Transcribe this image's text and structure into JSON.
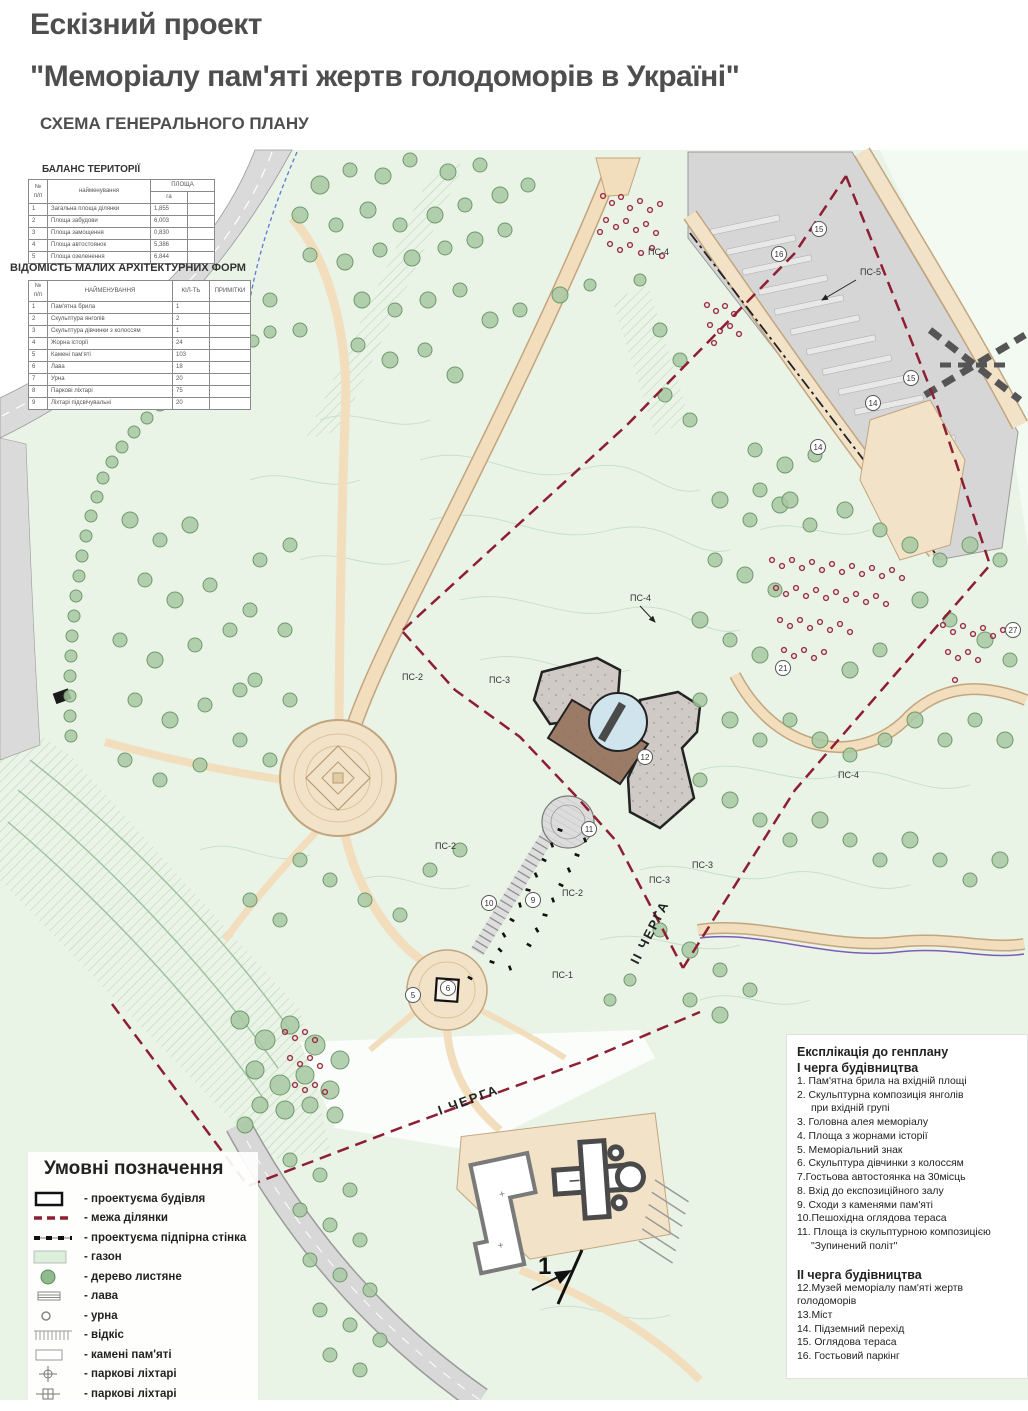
{
  "header": {
    "line1": "Ескізний проект",
    "line2": "\"Меморіалу пам'яті жертв голодоморів в Україні\"",
    "line3": "СХЕМА ГЕНЕРАЛЬНОГО ПЛАНУ"
  },
  "balance_table": {
    "title": "БАЛАНС ТЕРИТОРІЇ",
    "col_num": "№ п/п",
    "col_name": "найменування",
    "col_area": "ПЛОЩА",
    "col_unit": "га",
    "rows": [
      {
        "n": "1",
        "name": "Загальна площа ділянки",
        "val": "1,855"
      },
      {
        "n": "2",
        "name": "Площа забудови",
        "val": "6,003"
      },
      {
        "n": "3",
        "name": "Площа замощення",
        "val": "0,830"
      },
      {
        "n": "4",
        "name": "Площа автостоянок",
        "val": "5,386"
      },
      {
        "n": "5",
        "name": "Площа озеленення",
        "val": "6,844"
      }
    ]
  },
  "maf_table": {
    "title": "ВІДОМІСТЬ МАЛИХ АРХІТЕКТУРНИХ ФОРМ",
    "col_num": "№ п/п",
    "col_name": "НАЙМЕНУВАННЯ",
    "col_qty": "КІЛ-ТЬ",
    "col_notes": "ПРИМІТКИ",
    "rows": [
      {
        "n": "1",
        "name": "Пам'ятна брила",
        "qty": "1"
      },
      {
        "n": "2",
        "name": "Скульптура янголів",
        "qty": "2"
      },
      {
        "n": "3",
        "name": "Скульптура дівчинки з колоссям",
        "qty": "1"
      },
      {
        "n": "4",
        "name": "Жорна історії",
        "qty": "24"
      },
      {
        "n": "5",
        "name": "Камені пам'яті",
        "qty": "103"
      },
      {
        "n": "6",
        "name": "Лава",
        "qty": "18"
      },
      {
        "n": "7",
        "name": "Урна",
        "qty": "20"
      },
      {
        "n": "8",
        "name": "Паркові ліхтарі",
        "qty": "75"
      },
      {
        "n": "9",
        "name": "Ліхтарі підсвічувальні",
        "qty": "20"
      }
    ]
  },
  "legend": {
    "title": "Умовні позначення",
    "items": [
      {
        "symbol": "building-outline",
        "label": "- проектуєма будівля"
      },
      {
        "symbol": "site-boundary-dashed",
        "label": "- межа ділянки"
      },
      {
        "symbol": "retaining-wall-dashed",
        "label": "- проектуєма підпірна стінка"
      },
      {
        "symbol": "lawn-fill",
        "label": "- газон"
      },
      {
        "symbol": "deciduous-tree",
        "label": "- дерево листяне"
      },
      {
        "symbol": "bench",
        "label": "- лава"
      },
      {
        "symbol": "urn",
        "label": "- урна"
      },
      {
        "symbol": "slope-hatch",
        "label": "- відкіс"
      },
      {
        "symbol": "memory-stones",
        "label": "- камені пам'яті"
      },
      {
        "symbol": "park-lantern-1",
        "label": "- паркові ліхтарі"
      },
      {
        "symbol": "park-lantern-2",
        "label": "- паркові ліхтарі"
      }
    ]
  },
  "explication": {
    "title": "Експлікація до генплану",
    "phase1_title": "І черга будівництва",
    "phase1_lines": [
      "1. Пам'ятна брила на вхідній площі",
      "2. Скульптурна композиція янголів",
      "при вхідній групі",
      "3. Головна алея меморіалу",
      "4. Площа з жорнами історії",
      "5. Меморіальний знак",
      "6. Скульптура дівчинки з колоссям",
      "7.Гостьова автостоянка на 30місць",
      "8. Вхід до експозиційного залу",
      "9. Сходи з каменями пам'яті",
      "10.Пешохідна оглядова тераса",
      "11. Площа із скульптурною композицією",
      "\"Зупинений політ\""
    ],
    "phase2_title": "ІІ черга будівництва",
    "phase2_lines": [
      "12.Музей меморіалу пам'яті жертв  голодоморів",
      "13.Міст",
      "14. Підземний перехід",
      "15. Оглядова тераса",
      "16.  Гостьовий паркінг"
    ]
  },
  "map": {
    "ps": [
      "ПС-4",
      "ПС-5",
      "ПС-4",
      "ПС-2",
      "ПС-3",
      "ПС-4",
      "ПС-2",
      "ПС-3",
      "ПС-3",
      "ПС-2",
      "ПС-1"
    ],
    "badges": [
      "15",
      "16",
      "15",
      "14",
      "14",
      "21",
      "27",
      "12",
      "11",
      "10",
      "9",
      "6",
      "5"
    ],
    "phase1_label": "І ЧЕРГА",
    "phase2_label": "ІІ ЧЕРГА",
    "north_label": "1"
  },
  "colors": {
    "title_text": "#4e4e4e",
    "boundary_red": "#8e1f33",
    "path_tan": "#f2ddbd",
    "park_green": "#e9f3e6",
    "tree_green": "#a8c8a2",
    "shrub_red": "#9c2f44",
    "road_gray": "#d6d6d6",
    "museum_brown": "#9c7b66",
    "museum_gray": "#cfcac6",
    "pool_blue": "#cfe4ec"
  },
  "map_decor": {
    "trees": [
      [
        320,
        185,
        9
      ],
      [
        350,
        170,
        7
      ],
      [
        383,
        176,
        8
      ],
      [
        410,
        160,
        7
      ],
      [
        448,
        172,
        8
      ],
      [
        480,
        165,
        7
      ],
      [
        300,
        215,
        8
      ],
      [
        336,
        225,
        7
      ],
      [
        368,
        210,
        8
      ],
      [
        400,
        225,
        7
      ],
      [
        435,
        215,
        8
      ],
      [
        465,
        205,
        7
      ],
      [
        500,
        195,
        8
      ],
      [
        528,
        185,
        7
      ],
      [
        310,
        255,
        7
      ],
      [
        345,
        262,
        8
      ],
      [
        380,
        250,
        7
      ],
      [
        412,
        258,
        8
      ],
      [
        445,
        248,
        7
      ],
      [
        475,
        240,
        8
      ],
      [
        505,
        230,
        7
      ],
      [
        362,
        300,
        8
      ],
      [
        395,
        310,
        7
      ],
      [
        428,
        300,
        8
      ],
      [
        460,
        290,
        7
      ],
      [
        490,
        320,
        8
      ],
      [
        520,
        310,
        7
      ],
      [
        560,
        295,
        8
      ],
      [
        590,
        285,
        6
      ],
      [
        640,
        280,
        6
      ],
      [
        358,
        345,
        7
      ],
      [
        390,
        360,
        8
      ],
      [
        425,
        350,
        7
      ],
      [
        455,
        375,
        8
      ],
      [
        300,
        330,
        7
      ],
      [
        270,
        300,
        7
      ],
      [
        112,
        462,
        6
      ],
      [
        122,
        447,
        6
      ],
      [
        134,
        432,
        6
      ],
      [
        147,
        418,
        6
      ],
      [
        160,
        405,
        6
      ],
      [
        175,
        393,
        6
      ],
      [
        190,
        381,
        6
      ],
      [
        205,
        370,
        6
      ],
      [
        221,
        360,
        6
      ],
      [
        237,
        350,
        6
      ],
      [
        253,
        341,
        6
      ],
      [
        270,
        332,
        6
      ],
      [
        103,
        478,
        6
      ],
      [
        97,
        497,
        6
      ],
      [
        91,
        516,
        6
      ],
      [
        86,
        536,
        6
      ],
      [
        82,
        556,
        6
      ],
      [
        79,
        576,
        6
      ],
      [
        76,
        596,
        6
      ],
      [
        74,
        616,
        6
      ],
      [
        72,
        636,
        6
      ],
      [
        71,
        656,
        6
      ],
      [
        70,
        676,
        6
      ],
      [
        70,
        696,
        6
      ],
      [
        70,
        716,
        6
      ],
      [
        71,
        736,
        6
      ],
      [
        130,
        520,
        8
      ],
      [
        160,
        540,
        7
      ],
      [
        190,
        525,
        8
      ],
      [
        145,
        580,
        7
      ],
      [
        175,
        600,
        8
      ],
      [
        210,
        585,
        7
      ],
      [
        120,
        640,
        7
      ],
      [
        155,
        660,
        8
      ],
      [
        195,
        645,
        7
      ],
      [
        230,
        630,
        7
      ],
      [
        135,
        700,
        7
      ],
      [
        170,
        720,
        8
      ],
      [
        205,
        705,
        7
      ],
      [
        240,
        690,
        7
      ],
      [
        125,
        760,
        7
      ],
      [
        160,
        780,
        7
      ],
      [
        200,
        765,
        7
      ],
      [
        260,
        560,
        7
      ],
      [
        290,
        545,
        7
      ],
      [
        250,
        610,
        7
      ],
      [
        285,
        630,
        7
      ],
      [
        255,
        680,
        7
      ],
      [
        290,
        700,
        7
      ],
      [
        240,
        740,
        7
      ],
      [
        270,
        760,
        7
      ],
      [
        300,
        860,
        7
      ],
      [
        330,
        880,
        7
      ],
      [
        365,
        900,
        7
      ],
      [
        400,
        915,
        7
      ],
      [
        430,
        870,
        7
      ],
      [
        460,
        850,
        7
      ],
      [
        250,
        900,
        7
      ],
      [
        280,
        920,
        7
      ],
      [
        240,
        1020,
        9
      ],
      [
        265,
        1040,
        10
      ],
      [
        290,
        1025,
        9
      ],
      [
        315,
        1045,
        10
      ],
      [
        340,
        1060,
        9
      ],
      [
        255,
        1070,
        9
      ],
      [
        280,
        1085,
        10
      ],
      [
        305,
        1075,
        9
      ],
      [
        330,
        1090,
        9
      ],
      [
        260,
        1105,
        8
      ],
      [
        285,
        1110,
        9
      ],
      [
        310,
        1105,
        8
      ],
      [
        245,
        1125,
        8
      ],
      [
        335,
        1115,
        8
      ],
      [
        290,
        1160,
        7
      ],
      [
        320,
        1175,
        7
      ],
      [
        350,
        1190,
        7
      ],
      [
        300,
        1210,
        7
      ],
      [
        330,
        1225,
        7
      ],
      [
        360,
        1240,
        7
      ],
      [
        310,
        1260,
        7
      ],
      [
        340,
        1275,
        7
      ],
      [
        370,
        1290,
        7
      ],
      [
        320,
        1310,
        7
      ],
      [
        350,
        1325,
        7
      ],
      [
        380,
        1340,
        7
      ],
      [
        330,
        1355,
        7
      ],
      [
        360,
        1370,
        7
      ],
      [
        720,
        500,
        8
      ],
      [
        750,
        520,
        7
      ],
      [
        780,
        505,
        8
      ],
      [
        810,
        525,
        7
      ],
      [
        845,
        510,
        8
      ],
      [
        880,
        530,
        7
      ],
      [
        910,
        545,
        8
      ],
      [
        940,
        560,
        7
      ],
      [
        970,
        545,
        8
      ],
      [
        1000,
        560,
        7
      ],
      [
        715,
        560,
        7
      ],
      [
        745,
        575,
        8
      ],
      [
        775,
        590,
        7
      ],
      [
        700,
        620,
        8
      ],
      [
        730,
        640,
        7
      ],
      [
        760,
        655,
        8
      ],
      [
        920,
        600,
        8
      ],
      [
        950,
        620,
        7
      ],
      [
        985,
        640,
        8
      ],
      [
        1010,
        660,
        7
      ],
      [
        880,
        650,
        7
      ],
      [
        850,
        670,
        8
      ],
      [
        700,
        700,
        7
      ],
      [
        730,
        720,
        8
      ],
      [
        760,
        740,
        7
      ],
      [
        790,
        720,
        7
      ],
      [
        820,
        740,
        8
      ],
      [
        850,
        755,
        7
      ],
      [
        885,
        740,
        7
      ],
      [
        915,
        720,
        8
      ],
      [
        945,
        740,
        7
      ],
      [
        975,
        720,
        7
      ],
      [
        1005,
        740,
        8
      ],
      [
        700,
        780,
        7
      ],
      [
        730,
        800,
        8
      ],
      [
        760,
        820,
        7
      ],
      [
        790,
        840,
        7
      ],
      [
        820,
        820,
        8
      ],
      [
        850,
        840,
        7
      ],
      [
        880,
        860,
        7
      ],
      [
        910,
        840,
        8
      ],
      [
        940,
        860,
        7
      ],
      [
        970,
        880,
        7
      ],
      [
        1000,
        860,
        8
      ],
      [
        660,
        930,
        7
      ],
      [
        690,
        950,
        8
      ],
      [
        720,
        970,
        7
      ],
      [
        750,
        990,
        7
      ],
      [
        690,
        1000,
        7
      ],
      [
        720,
        1015,
        8
      ],
      [
        630,
        980,
        6
      ],
      [
        610,
        1000,
        6
      ],
      [
        755,
        450,
        7
      ],
      [
        785,
        465,
        8
      ],
      [
        815,
        455,
        7
      ],
      [
        760,
        490,
        7
      ],
      [
        790,
        500,
        8
      ],
      [
        660,
        330,
        7
      ],
      [
        680,
        360,
        7
      ],
      [
        665,
        395,
        7
      ],
      [
        690,
        420,
        7
      ]
    ],
    "shrubs": [
      [
        603,
        196
      ],
      [
        612,
        203
      ],
      [
        621,
        197
      ],
      [
        630,
        208
      ],
      [
        640,
        201
      ],
      [
        650,
        210
      ],
      [
        660,
        204
      ],
      [
        606,
        220
      ],
      [
        616,
        227
      ],
      [
        626,
        221
      ],
      [
        636,
        230
      ],
      [
        646,
        224
      ],
      [
        656,
        233
      ],
      [
        610,
        244
      ],
      [
        620,
        250
      ],
      [
        630,
        245
      ],
      [
        641,
        253
      ],
      [
        652,
        248
      ],
      [
        662,
        256
      ],
      [
        600,
        232
      ],
      [
        707,
        305
      ],
      [
        716,
        311
      ],
      [
        725,
        306
      ],
      [
        734,
        314
      ],
      [
        710,
        325
      ],
      [
        720,
        331
      ],
      [
        730,
        326
      ],
      [
        739,
        334
      ],
      [
        714,
        343
      ],
      [
        772,
        560
      ],
      [
        782,
        566
      ],
      [
        792,
        560
      ],
      [
        802,
        568
      ],
      [
        812,
        562
      ],
      [
        822,
        570
      ],
      [
        832,
        564
      ],
      [
        842,
        572
      ],
      [
        852,
        566
      ],
      [
        862,
        574
      ],
      [
        872,
        568
      ],
      [
        882,
        576
      ],
      [
        892,
        570
      ],
      [
        902,
        578
      ],
      [
        776,
        588
      ],
      [
        786,
        594
      ],
      [
        796,
        588
      ],
      [
        806,
        596
      ],
      [
        816,
        590
      ],
      [
        826,
        598
      ],
      [
        836,
        592
      ],
      [
        846,
        600
      ],
      [
        856,
        594
      ],
      [
        866,
        602
      ],
      [
        876,
        596
      ],
      [
        886,
        604
      ],
      [
        780,
        620
      ],
      [
        790,
        626
      ],
      [
        800,
        620
      ],
      [
        810,
        628
      ],
      [
        820,
        622
      ],
      [
        830,
        630
      ],
      [
        840,
        624
      ],
      [
        850,
        632
      ],
      [
        784,
        650
      ],
      [
        794,
        656
      ],
      [
        804,
        650
      ],
      [
        814,
        658
      ],
      [
        824,
        652
      ],
      [
        943,
        625
      ],
      [
        953,
        632
      ],
      [
        963,
        626
      ],
      [
        973,
        634
      ],
      [
        983,
        628
      ],
      [
        993,
        636
      ],
      [
        1003,
        630
      ],
      [
        948,
        652
      ],
      [
        958,
        658
      ],
      [
        968,
        652
      ],
      [
        978,
        660
      ],
      [
        955,
        680
      ],
      [
        285,
        1032
      ],
      [
        295,
        1038
      ],
      [
        305,
        1032
      ],
      [
        315,
        1040
      ],
      [
        290,
        1058
      ],
      [
        300,
        1064
      ],
      [
        310,
        1058
      ],
      [
        320,
        1066
      ],
      [
        295,
        1085
      ],
      [
        305,
        1090
      ],
      [
        315,
        1085
      ],
      [
        325,
        1092
      ]
    ],
    "stones": [
      [
        560,
        830,
        20
      ],
      [
        552,
        845,
        70
      ],
      [
        544,
        860,
        25
      ],
      [
        536,
        875,
        65
      ],
      [
        528,
        890,
        15
      ],
      [
        520,
        905,
        75
      ],
      [
        512,
        920,
        30
      ],
      [
        504,
        935,
        60
      ],
      [
        585,
        840,
        70
      ],
      [
        577,
        855,
        20
      ],
      [
        569,
        870,
        65
      ],
      [
        561,
        885,
        25
      ],
      [
        553,
        900,
        70
      ],
      [
        545,
        915,
        15
      ],
      [
        537,
        930,
        60
      ],
      [
        529,
        945,
        30
      ],
      [
        500,
        950,
        45
      ],
      [
        492,
        962,
        20
      ],
      [
        510,
        968,
        70
      ],
      [
        470,
        978,
        30
      ]
    ]
  }
}
